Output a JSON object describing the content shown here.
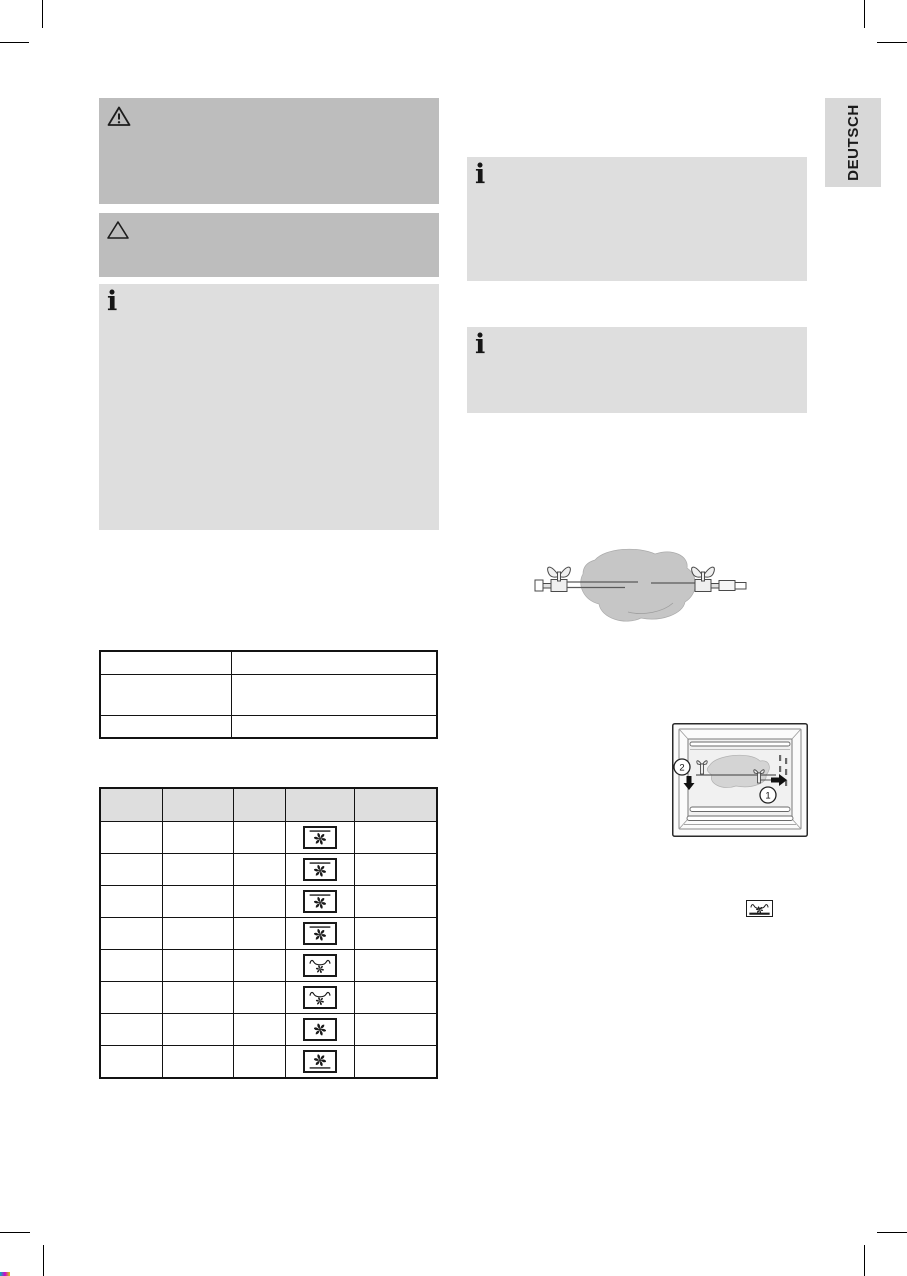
{
  "page": {
    "width": 907,
    "height": 1276,
    "language_tab": "DEUTSCH"
  },
  "colors": {
    "warning_bg": "#bdbdbd",
    "info_bg": "#dedede",
    "header_bg": "#dedede",
    "tab_bg": "#d8d8d8",
    "ink": "#1a1a1a",
    "illustration_fill": "#c6c6c6"
  },
  "glyphs": {
    "info": "i"
  },
  "left_column": {
    "warning_box_1": {
      "icon": "warning-triangle-exclamation",
      "text": ""
    },
    "warning_box_2": {
      "icon": "triangle-outline",
      "text": ""
    },
    "info_box": {
      "icon": "info",
      "text": ""
    }
  },
  "right_column": {
    "info_box_top": {
      "icon": "info",
      "text": ""
    },
    "info_box_bottom": {
      "icon": "info",
      "text": ""
    }
  },
  "small_table": {
    "rows": [
      {
        "col1": "",
        "col2": ""
      },
      {
        "col1": "",
        "col2": ""
      },
      {
        "col1": "",
        "col2": ""
      }
    ]
  },
  "cooking_table": {
    "columns": [
      "",
      "",
      "",
      "",
      ""
    ],
    "rows": [
      {
        "mode_icon": "fan-top-heat"
      },
      {
        "mode_icon": "fan-top-heat"
      },
      {
        "mode_icon": "fan-top-heat"
      },
      {
        "mode_icon": "fan-top-heat"
      },
      {
        "mode_icon": "fan-grill"
      },
      {
        "mode_icon": "fan-grill"
      },
      {
        "mode_icon": "fan-only"
      },
      {
        "mode_icon": "fan-bottom-heat"
      }
    ]
  },
  "inline_icon": {
    "name": "grill-fan"
  },
  "oven_illustration": {
    "callout_1": "1",
    "callout_2": "2"
  }
}
